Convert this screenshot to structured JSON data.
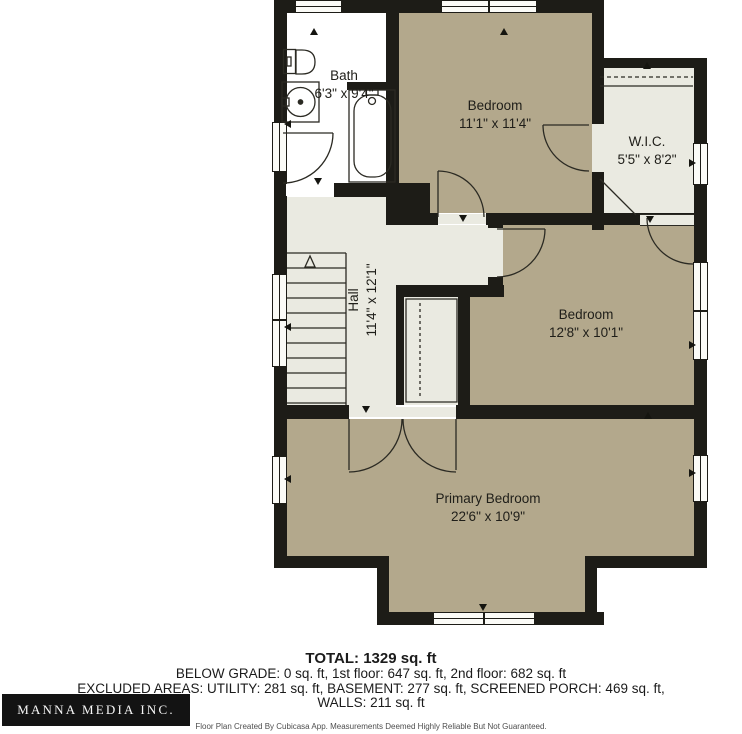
{
  "plan": {
    "rooms": [
      {
        "id": "bath",
        "name": "Bath",
        "dims": "6'3\" x 9'4\""
      },
      {
        "id": "bedroom-top",
        "name": "Bedroom",
        "dims": "11'1\" x 11'4\""
      },
      {
        "id": "wic",
        "name": "W.I.C.",
        "dims": "5'5\" x 8'2\""
      },
      {
        "id": "hall",
        "name": "Hall",
        "dims": "11'4\" x 12'1\""
      },
      {
        "id": "bedroom-mid",
        "name": "Bedroom",
        "dims": "12'8\" x 10'1\""
      },
      {
        "id": "primary",
        "name": "Primary Bedroom",
        "dims": "22'6\" x 10'9\""
      }
    ],
    "fixtures": [
      "toilet",
      "sink",
      "bathtub",
      "staircase",
      "closet-rod"
    ]
  },
  "summary": {
    "total": "TOTAL: 1329 sq. ft",
    "line1": "BELOW GRADE: 0 sq. ft, 1st floor: 647 sq. ft, 2nd floor: 682 sq. ft",
    "line2": "EXCLUDED AREAS: UTILITY: 281 sq. ft, BASEMENT: 277 sq. ft, SCREENED PORCH: 469 sq. ft,",
    "line3": "WALLS: 211 sq. ft",
    "disclaimer": "Floor Plan Created By Cubicasa App. Measurements Deemed Highly Reliable But Not Guaranteed."
  },
  "branding": {
    "logo_text": "MANNA MEDIA INC."
  },
  "colors": {
    "wall": "#1d1c17",
    "room_tan": "#b3a88c",
    "room_light": "#eaeae1",
    "bath_white": "#ffffff",
    "logo_bg": "#131313",
    "logo_text": "#f7f7f7"
  }
}
